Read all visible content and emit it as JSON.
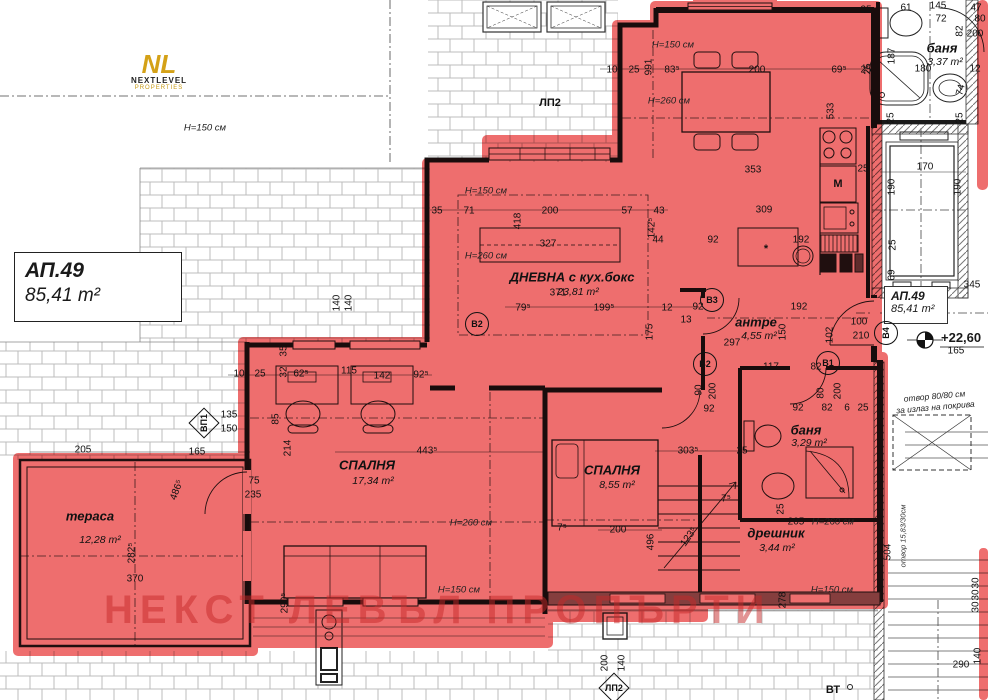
{
  "apartment": {
    "id": "АП.49",
    "area": "85,41 m²"
  },
  "title_box": {
    "id": "АП.49",
    "area": "85,41 m²"
  },
  "side_label": {
    "id": "АП.49",
    "area": "85,41 m²",
    "elevation": "+22,60"
  },
  "logo": {
    "mark": "NL",
    "name": "NEXTLEVEL",
    "sub": "PROPERTIES"
  },
  "watermark": "НЕКСТ ЛЕВЪЛ ПРОПЪРТИ",
  "notes": {
    "roof_line1": "отвор 80/80 см",
    "roof_line2": "за излаз на покрива",
    "stair": "отвор 15,83/30см"
  },
  "colors": {
    "highlight": "#ee6e6e",
    "watermark": "rgba(198,40,40,0.5)",
    "logo_gold": "#d4a117"
  },
  "rooms": [
    {
      "name": "ДНЕВНА с кух.бокс",
      "area": "23,81 m²",
      "x": 572,
      "y": 277,
      "ax": 578,
      "ay": 292
    },
    {
      "name": "СПАЛНЯ",
      "area": "17,34 m²",
      "x": 367,
      "y": 465,
      "ax": 373,
      "ay": 481
    },
    {
      "name": "СПАЛНЯ",
      "area": "8,55 m²",
      "x": 612,
      "y": 470,
      "ax": 617,
      "ay": 485
    },
    {
      "name": "тераса",
      "area": "12,28 m²",
      "x": 90,
      "y": 516,
      "ax": 100,
      "ay": 540
    },
    {
      "name": "баня",
      "area": "3,37 m²",
      "x": 942,
      "y": 48,
      "ax": 945,
      "ay": 62
    },
    {
      "name": "баня",
      "area": "3,29 m²",
      "x": 806,
      "y": 430,
      "ax": 809,
      "ay": 443
    },
    {
      "name": "антре",
      "area": "4,55 m²",
      "x": 756,
      "y": 322,
      "ax": 759,
      "ay": 336
    },
    {
      "name": "дрешник",
      "area": "3,44 m²",
      "x": 776,
      "y": 533,
      "ax": 777,
      "ay": 548
    }
  ],
  "markers": [
    {
      "label": "В1",
      "x": 828,
      "y": 363,
      "shape": "circle"
    },
    {
      "label": "В2",
      "x": 705,
      "y": 364,
      "shape": "circle"
    },
    {
      "label": "В2",
      "x": 477,
      "y": 324,
      "shape": "circle"
    },
    {
      "label": "В3",
      "x": 712,
      "y": 300,
      "shape": "circle"
    },
    {
      "label": "В4",
      "x": 886,
      "y": 333,
      "shape": "circle",
      "rot": -90
    },
    {
      "label": "ВП1",
      "x": 204,
      "y": 423,
      "shape": "diamond",
      "rot": -90
    },
    {
      "label": "ЛП2",
      "x": 550,
      "y": 103,
      "shape": "plain"
    },
    {
      "label": "ЛП2",
      "x": 614,
      "y": 688,
      "shape": "diamond"
    },
    {
      "label": "ВТ",
      "x": 833,
      "y": 690,
      "shape": "plain"
    },
    {
      "label": "М",
      "x": 838,
      "y": 184,
      "shape": "plain"
    },
    {
      "label": "*",
      "x": 766,
      "y": 249,
      "shape": "plain"
    }
  ],
  "dims": [
    {
      "t": "35",
      "x": 866,
      "y": 10
    },
    {
      "t": "61",
      "x": 906,
      "y": 8
    },
    {
      "t": "145",
      "x": 938,
      "y": 6
    },
    {
      "t": "72",
      "x": 941,
      "y": 19
    },
    {
      "t": "47",
      "x": 976,
      "y": 8
    },
    {
      "t": "80",
      "x": 980,
      "y": 19
    },
    {
      "t": "82",
      "x": 960,
      "y": 31,
      "r": -90
    },
    {
      "t": "200",
      "x": 975,
      "y": 34
    },
    {
      "t": "187",
      "x": 892,
      "y": 56,
      "r": -90
    },
    {
      "t": "180",
      "x": 923,
      "y": 69
    },
    {
      "t": "25",
      "x": 868,
      "y": 69,
      "r": -90
    },
    {
      "t": "12",
      "x": 975,
      "y": 69
    },
    {
      "t": "74",
      "x": 961,
      "y": 90,
      "r": -75
    },
    {
      "t": "25",
      "x": 891,
      "y": 118,
      "r": -90
    },
    {
      "t": "25",
      "x": 960,
      "y": 118,
      "r": -90
    },
    {
      "t": "10",
      "x": 612,
      "y": 70
    },
    {
      "t": "25",
      "x": 634,
      "y": 70
    },
    {
      "t": "991",
      "x": 649,
      "y": 67,
      "r": -90
    },
    {
      "t": "83⁵",
      "x": 672,
      "y": 70
    },
    {
      "t": "200",
      "x": 757,
      "y": 70
    },
    {
      "t": "69⁵",
      "x": 839,
      "y": 70
    },
    {
      "t": "25",
      "x": 866,
      "y": 70
    },
    {
      "t": "533",
      "x": 831,
      "y": 111,
      "r": -90
    },
    {
      "t": "353",
      "x": 753,
      "y": 170
    },
    {
      "t": "309",
      "x": 764,
      "y": 210
    },
    {
      "t": "25",
      "x": 863,
      "y": 169
    },
    {
      "t": "192",
      "x": 801,
      "y": 240
    },
    {
      "t": "92",
      "x": 713,
      "y": 240
    },
    {
      "t": "35",
      "x": 437,
      "y": 211
    },
    {
      "t": "71",
      "x": 469,
      "y": 211
    },
    {
      "t": "418",
      "x": 518,
      "y": 221,
      "r": -90
    },
    {
      "t": "200",
      "x": 550,
      "y": 211
    },
    {
      "t": "57",
      "x": 627,
      "y": 211
    },
    {
      "t": "43",
      "x": 659,
      "y": 211
    },
    {
      "t": "142⁵",
      "x": 652,
      "y": 228,
      "r": -90
    },
    {
      "t": "44",
      "x": 658,
      "y": 240
    },
    {
      "t": "327",
      "x": 548,
      "y": 244
    },
    {
      "t": "371",
      "x": 558,
      "y": 293
    },
    {
      "t": "79⁵",
      "x": 523,
      "y": 308
    },
    {
      "t": "199⁵",
      "x": 604,
      "y": 308
    },
    {
      "t": "12",
      "x": 667,
      "y": 308
    },
    {
      "t": "13",
      "x": 686,
      "y": 320
    },
    {
      "t": "175",
      "x": 650,
      "y": 332,
      "r": -90
    },
    {
      "t": "92",
      "x": 698,
      "y": 307
    },
    {
      "t": "192",
      "x": 799,
      "y": 307
    },
    {
      "t": "150",
      "x": 783,
      "y": 332,
      "r": -90
    },
    {
      "t": "102",
      "x": 830,
      "y": 335,
      "r": -90
    },
    {
      "t": "100",
      "x": 859,
      "y": 322
    },
    {
      "t": "210",
      "x": 861,
      "y": 336
    },
    {
      "t": "297",
      "x": 732,
      "y": 343
    },
    {
      "t": "117",
      "x": 771,
      "y": 367
    },
    {
      "t": "82",
      "x": 816,
      "y": 367
    },
    {
      "t": "92",
      "x": 709,
      "y": 409
    },
    {
      "t": "90",
      "x": 699,
      "y": 390,
      "r": -90
    },
    {
      "t": "200",
      "x": 713,
      "y": 391,
      "r": -90
    },
    {
      "t": "92",
      "x": 798,
      "y": 408
    },
    {
      "t": "82",
      "x": 827,
      "y": 408
    },
    {
      "t": "6",
      "x": 847,
      "y": 408
    },
    {
      "t": "25",
      "x": 863,
      "y": 408
    },
    {
      "t": "80",
      "x": 821,
      "y": 393,
      "r": -90
    },
    {
      "t": "200",
      "x": 838,
      "y": 391,
      "r": -90
    },
    {
      "t": "10",
      "x": 239,
      "y": 374
    },
    {
      "t": "25",
      "x": 260,
      "y": 374
    },
    {
      "t": "35",
      "x": 284,
      "y": 351,
      "r": -90
    },
    {
      "t": "32",
      "x": 284,
      "y": 372,
      "r": -90
    },
    {
      "t": "62⁵",
      "x": 301,
      "y": 374
    },
    {
      "t": "115",
      "x": 349,
      "y": 371
    },
    {
      "t": "142",
      "x": 382,
      "y": 376
    },
    {
      "t": "92⁵",
      "x": 421,
      "y": 375
    },
    {
      "t": "85",
      "x": 276,
      "y": 419,
      "r": -90
    },
    {
      "t": "135",
      "x": 229,
      "y": 415
    },
    {
      "t": "150",
      "x": 229,
      "y": 429
    },
    {
      "t": "140",
      "x": 337,
      "y": 303,
      "r": -90
    },
    {
      "t": "140",
      "x": 349,
      "y": 303,
      "r": -90
    },
    {
      "t": "165",
      "x": 197,
      "y": 452
    },
    {
      "t": "205",
      "x": 83,
      "y": 450
    },
    {
      "t": "443⁵",
      "x": 427,
      "y": 451
    },
    {
      "t": "214",
      "x": 288,
      "y": 448,
      "r": -90
    },
    {
      "t": "75",
      "x": 254,
      "y": 481
    },
    {
      "t": "235",
      "x": 253,
      "y": 495
    },
    {
      "t": "486⁵",
      "x": 177,
      "y": 490,
      "r": -70
    },
    {
      "t": "282⁵",
      "x": 132,
      "y": 553,
      "r": -90
    },
    {
      "t": "370",
      "x": 135,
      "y": 579
    },
    {
      "t": "290⁵",
      "x": 285,
      "y": 603,
      "r": -90
    },
    {
      "t": "303⁵",
      "x": 688,
      "y": 451
    },
    {
      "t": "25",
      "x": 742,
      "y": 451
    },
    {
      "t": "200",
      "x": 618,
      "y": 530
    },
    {
      "t": "496",
      "x": 651,
      "y": 542,
      "r": -90
    },
    {
      "t": "123⁵",
      "x": 689,
      "y": 537,
      "r": -55
    },
    {
      "t": "7⁵",
      "x": 726,
      "y": 499
    },
    {
      "t": "7⁵",
      "x": 562,
      "y": 528
    },
    {
      "t": "205",
      "x": 796,
      "y": 522
    },
    {
      "t": "25",
      "x": 781,
      "y": 509,
      "r": -90
    },
    {
      "t": "278",
      "x": 783,
      "y": 600,
      "r": -90
    },
    {
      "t": "170",
      "x": 925,
      "y": 167
    },
    {
      "t": "190",
      "x": 892,
      "y": 187,
      "r": -90
    },
    {
      "t": "190",
      "x": 958,
      "y": 187,
      "r": -90
    },
    {
      "t": "25",
      "x": 893,
      "y": 245,
      "r": -90
    },
    {
      "t": "69",
      "x": 892,
      "y": 275,
      "r": -90
    },
    {
      "t": "345",
      "x": 972,
      "y": 285
    },
    {
      "t": "504",
      "x": 888,
      "y": 552,
      "r": -90
    },
    {
      "t": "290",
      "x": 961,
      "y": 665
    },
    {
      "t": "140",
      "x": 978,
      "y": 656,
      "r": -90
    },
    {
      "t": "30",
      "x": 976,
      "y": 583,
      "r": -90
    },
    {
      "t": "30",
      "x": 976,
      "y": 595,
      "r": -90
    },
    {
      "t": "30",
      "x": 976,
      "y": 607,
      "r": -90
    },
    {
      "t": "200",
      "x": 605,
      "y": 663,
      "r": -90
    },
    {
      "t": "140",
      "x": 622,
      "y": 663,
      "r": -90
    },
    {
      "t": "165",
      "x": 956,
      "y": 351
    },
    {
      "t": "H=150 см",
      "x": 205,
      "y": 128,
      "c": "h"
    },
    {
      "t": "H=150 см",
      "x": 673,
      "y": 45,
      "c": "h"
    },
    {
      "t": "H=260 см",
      "x": 669,
      "y": 101,
      "c": "h"
    },
    {
      "t": "H=150 см",
      "x": 486,
      "y": 191,
      "c": "h"
    },
    {
      "t": "H=260 см",
      "x": 486,
      "y": 256,
      "c": "h"
    },
    {
      "t": "H=260 см",
      "x": 471,
      "y": 523,
      "c": "h"
    },
    {
      "t": "H=150 см",
      "x": 459,
      "y": 590,
      "c": "h"
    },
    {
      "t": "H=260 см",
      "x": 833,
      "y": 522,
      "c": "h"
    },
    {
      "t": "H=150 см",
      "x": 832,
      "y": 590,
      "c": "h"
    }
  ]
}
